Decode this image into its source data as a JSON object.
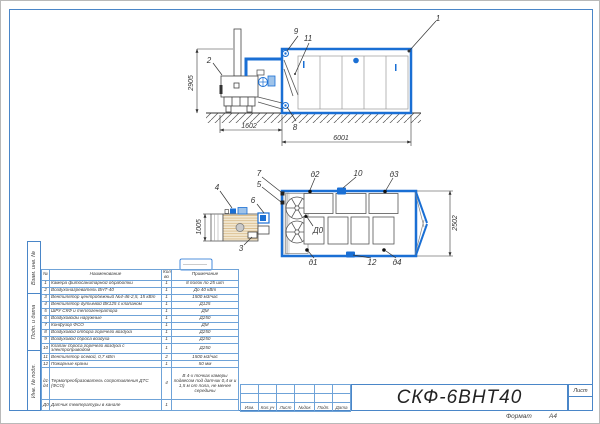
{
  "stamps": [
    "Взам. инв. №",
    "Подп. и дата",
    "Инв. № подл."
  ],
  "title_block": {
    "doc_number": "СКФ-6ВНТ40",
    "sheet_label": "Лист",
    "format_label": "Формат",
    "format_value": "А4",
    "rev_labels": [
      "Изм.",
      "Кол.уч",
      "Лист",
      "№док",
      "Подп.",
      "Дата"
    ]
  },
  "parts_table": {
    "headers": {
      "num": "№",
      "name": "Наименование",
      "qty": "Кол-во",
      "note": "Примечание"
    },
    "rows": [
      {
        "num": "1",
        "name": "Камера фитосанитарной обработки",
        "qty": "1",
        "note": "8 полок по 25 шт"
      },
      {
        "num": "2",
        "name": "Воздухонагреватель ВНТ-40",
        "qty": "1",
        "note": "До 40 кВт"
      },
      {
        "num": "3",
        "name": "Вентилятор центробежный №4-46-2,5, 15 кВт",
        "qty": "1",
        "note": "1500 м3/час"
      },
      {
        "num": "4",
        "name": "Вентилятор дутьевой ВК125 с клапаном",
        "qty": "1",
        "note": "Д125"
      },
      {
        "num": "5",
        "name": "ШРУ СКФ и теплогенератора",
        "qty": "1",
        "note": "ДМ"
      },
      {
        "num": "6",
        "name": "Воздуховоды наружные",
        "qty": "1",
        "note": "Д250"
      },
      {
        "num": "7",
        "name": "Конфузор ФСО",
        "qty": "1",
        "note": "ДМ"
      },
      {
        "num": "8",
        "name": "Воздуховод отбора горячего воздуха",
        "qty": "1",
        "note": "Д250"
      },
      {
        "num": "9",
        "name": "Воздуховод сброса воздуха",
        "qty": "1",
        "note": "Д250"
      },
      {
        "num": "10",
        "name": "Клапан сброса горячего воздуха с электроприводом",
        "qty": "1",
        "note": "Д250"
      },
      {
        "num": "11",
        "name": "Вентилятор осевой, 0,7 кВт",
        "qty": "2",
        "note": "1500 м3/час"
      },
      {
        "num": "12",
        "name": "Пожарные краны",
        "qty": "1",
        "note": "50 мм"
      },
      {
        "num": "д1-д4",
        "name": "Термопреобразователь сопротивления ДТС (ФСО)",
        "qty": "4",
        "note": "В 4-х точках камеры подвесом под датчик 0,4 м и 1,5 м от пола, не менее середины"
      },
      {
        "num": "Д0",
        "name": "Датчик температуры в канале",
        "qty": "1",
        "note": ""
      }
    ]
  },
  "side_view": {
    "callouts": {
      "c1": "1",
      "c2": "2",
      "c8": "8",
      "c9": "9",
      "c11": "11"
    },
    "dims": {
      "height": "2905",
      "left_width": "1602",
      "length": "6001"
    }
  },
  "plan_view": {
    "callouts": {
      "c3": "3",
      "c4": "4",
      "c5": "5",
      "c6": "6",
      "c7": "7",
      "c10": "10",
      "c12": "12",
      "d1": "д1",
      "d2": "д2",
      "d3": "д3",
      "d4": "д4",
      "d0": "Д0"
    },
    "dims": {
      "depth": "1005",
      "width": "2502"
    }
  }
}
